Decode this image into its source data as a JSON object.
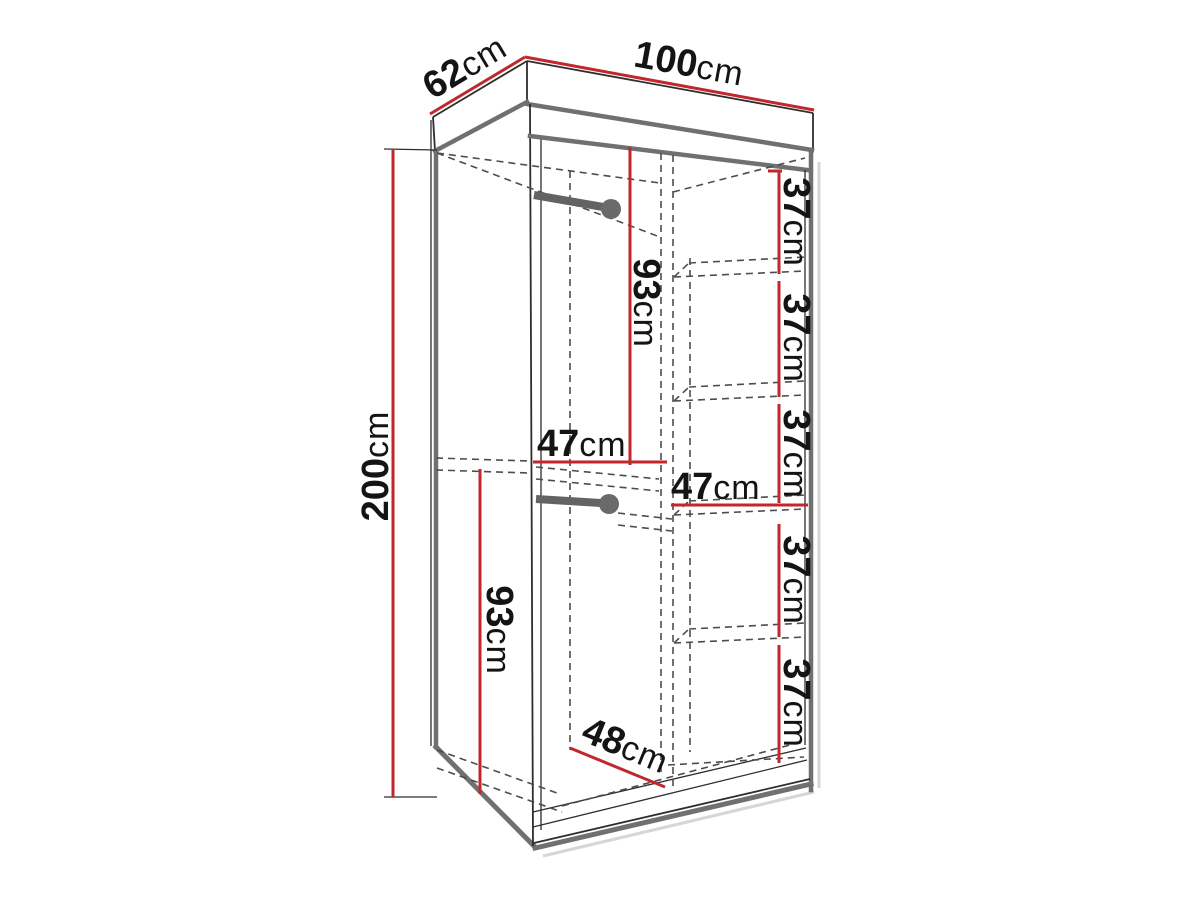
{
  "page": {
    "background": "#ffffff",
    "description": "Technical dimension diagram of a two-section wardrobe shown in perspective with red dimension lines"
  },
  "diagram": {
    "type": "furniture-dimension-drawing",
    "subject": "wardrobe with hanging rails and shelf column",
    "colors": {
      "dimension_line": "#c1272d",
      "outline": "#2e2e2e",
      "panel_edge": "#707070",
      "hidden_line": "#4d4d4d",
      "rod": "#636363",
      "text": "#141414"
    },
    "dims": {
      "depth": {
        "value": "62",
        "unit": "cm"
      },
      "width": {
        "value": "100",
        "unit": "cm"
      },
      "height": {
        "value": "200",
        "unit": "cm"
      },
      "upper_hanging_height": {
        "value": "93",
        "unit": "cm"
      },
      "upper_section_width": {
        "value": "47",
        "unit": "cm"
      },
      "lower_hanging_height": {
        "value": "93",
        "unit": "cm"
      },
      "bottom_depth": {
        "value": "48",
        "unit": "cm"
      },
      "shelf_section_width": {
        "value": "47",
        "unit": "cm"
      },
      "shelf_gaps": [
        {
          "value": "37",
          "unit": "cm"
        },
        {
          "value": "37",
          "unit": "cm"
        },
        {
          "value": "37",
          "unit": "cm"
        },
        {
          "value": "37",
          "unit": "cm"
        },
        {
          "value": "37",
          "unit": "cm"
        }
      ]
    }
  }
}
